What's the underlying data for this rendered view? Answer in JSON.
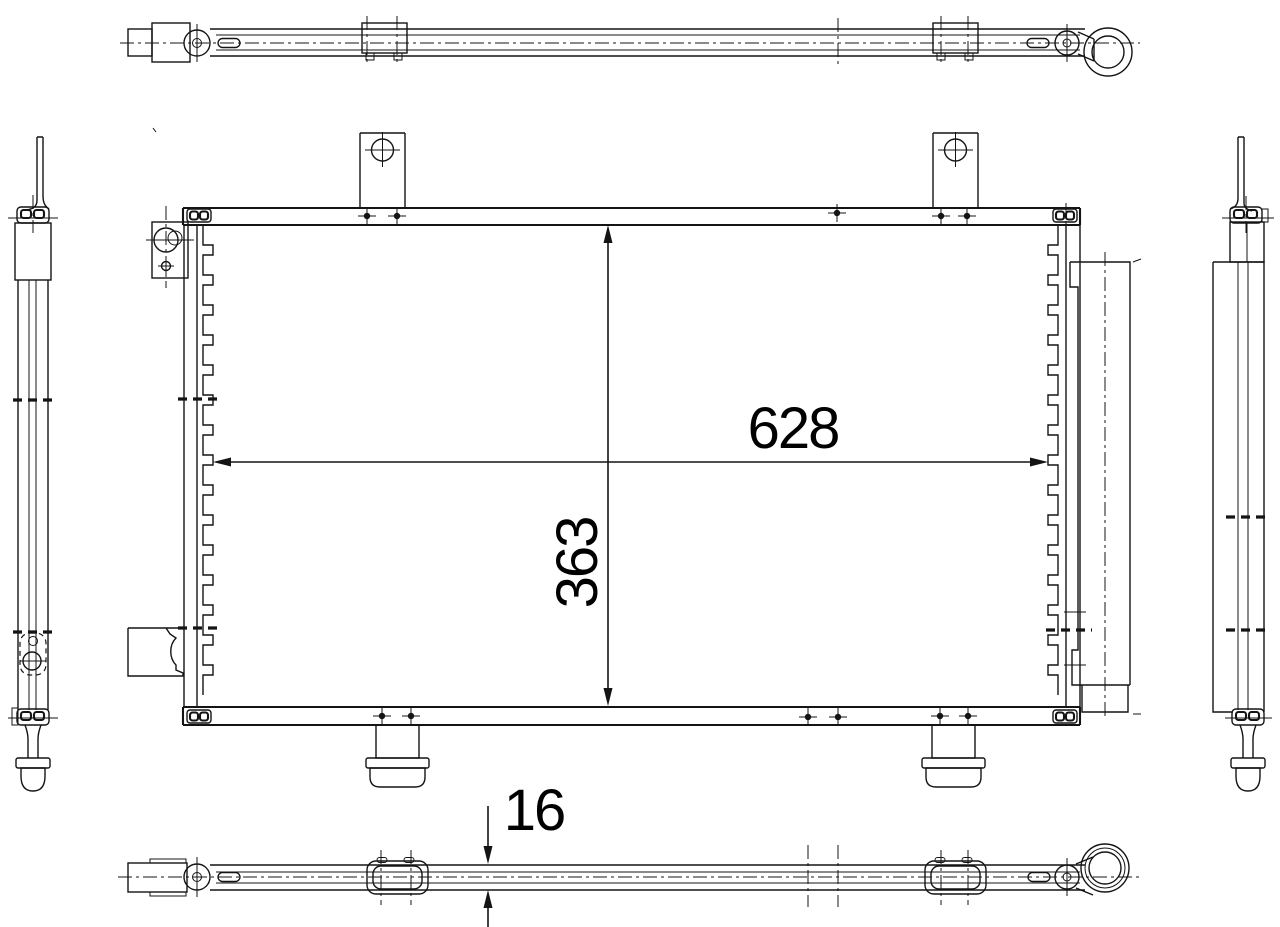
{
  "colors": {
    "background": "#ffffff",
    "line": "#141414",
    "text": "#000000"
  },
  "dimensions": {
    "width": "628",
    "height": "363",
    "thickness": "16"
  }
}
